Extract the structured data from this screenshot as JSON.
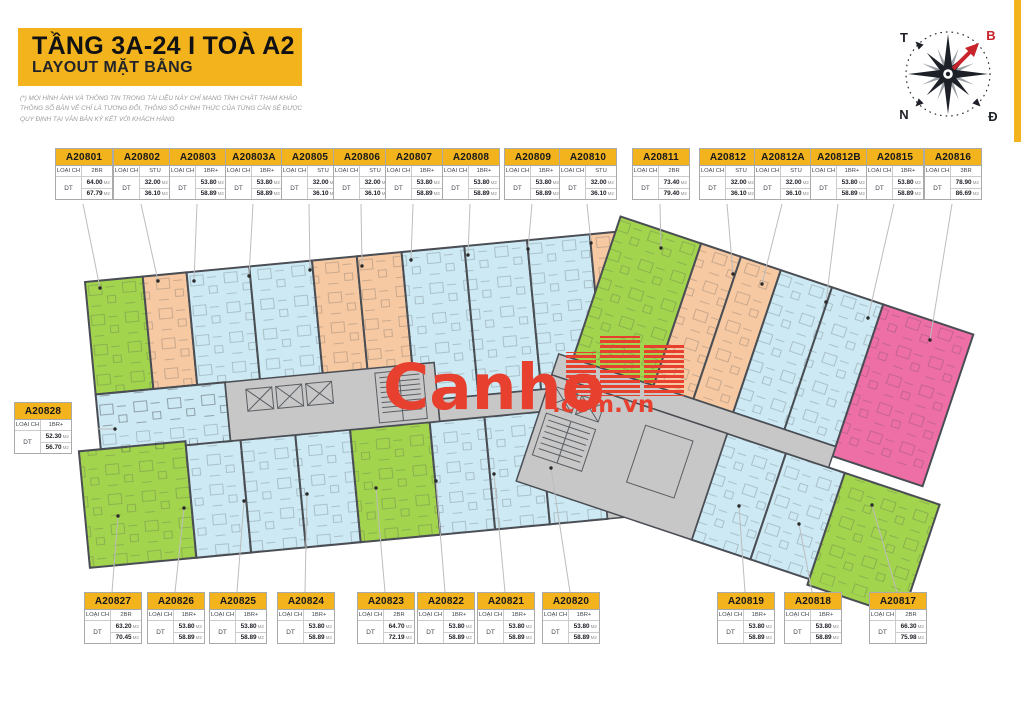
{
  "title_block": {
    "line1": "TẦNG 3A-24 I TOÀ A2",
    "line2": "LAYOUT MẶT BẰNG",
    "disclaimer": [
      "(*) MỌI HÌNH ẢNH VÀ THÔNG TIN TRONG TÀI LIỆU NÀY CHỈ MANG TÍNH CHẤT THAM KHẢO",
      "THÔNG SỐ BẢN VẼ CHỈ LÀ TƯƠNG ĐỐI, THÔNG SỐ CHÍNH THỨC CỦA TỪNG CĂN SẼ ĐƯỢC",
      "QUY ĐỊNH TẠI VĂN BẢN KÝ KẾT VỚI KHÁCH HÀNG"
    ]
  },
  "compass": {
    "nw": "T",
    "ne": "B",
    "sw": "N",
    "se": "Đ",
    "needle_color": "#c8232b"
  },
  "watermark": {
    "brand": "Canho",
    "suffix": ".com.vn",
    "color": "#e8402f"
  },
  "labels": {
    "type_key": "LOẠI CH",
    "area_key": "DT",
    "unit": "M2"
  },
  "colors": {
    "header_yellow": "#f2b31c",
    "unit_2br_green": "#a3d44e",
    "unit_stu_orange": "#f6c9a2",
    "unit_1brplus_blue": "#cde9f3",
    "unit_3br_pink": "#ee6ea6",
    "corridor_gray": "#c7c7c7",
    "brand_red": "#e8402f"
  },
  "units": {
    "top": [
      {
        "id": "A20801",
        "type": "2BR",
        "a1": "64.00",
        "a2": "67.79",
        "color": "green",
        "x": 55
      },
      {
        "id": "A20802",
        "type": "STU",
        "a1": "32.00",
        "a2": "36.10",
        "color": "orange",
        "x": 113
      },
      {
        "id": "A20803",
        "type": "1BR+",
        "a1": "53.80",
        "a2": "58.89",
        "color": "blue",
        "x": 169
      },
      {
        "id": "A20803A",
        "type": "1BR+",
        "a1": "53.80",
        "a2": "58.89",
        "color": "blue",
        "x": 225
      },
      {
        "id": "A20805",
        "type": "STU",
        "a1": "32.00",
        "a2": "36.10",
        "color": "orange",
        "x": 281
      },
      {
        "id": "A20806",
        "type": "STU",
        "a1": "32.00",
        "a2": "36.10",
        "color": "orange",
        "x": 333
      },
      {
        "id": "A20807",
        "type": "1BR+",
        "a1": "53.80",
        "a2": "58.89",
        "color": "blue",
        "x": 385
      },
      {
        "id": "A20808",
        "type": "1BR+",
        "a1": "53.80",
        "a2": "58.89",
        "color": "blue",
        "x": 442
      },
      {
        "id": "A20809",
        "type": "1BR+",
        "a1": "53.80",
        "a2": "58.89",
        "color": "blue",
        "x": 504
      },
      {
        "id": "A20810",
        "type": "STU",
        "a1": "32.00",
        "a2": "36.10",
        "color": "orange",
        "x": 559
      },
      {
        "id": "A20811",
        "type": "2BR",
        "a1": "73.40",
        "a2": "79.40",
        "color": "green",
        "x": 632
      },
      {
        "id": "A20812",
        "type": "STU",
        "a1": "32.00",
        "a2": "36.10",
        "color": "orange",
        "x": 699
      },
      {
        "id": "A20812A",
        "type": "STU",
        "a1": "32.00",
        "a2": "36.10",
        "color": "orange",
        "x": 754
      },
      {
        "id": "A20812B",
        "type": "1BR+",
        "a1": "53.80",
        "a2": "58.89",
        "color": "blue",
        "x": 810
      },
      {
        "id": "A20815",
        "type": "1BR+",
        "a1": "53.80",
        "a2": "58.89",
        "color": "blue",
        "x": 866
      },
      {
        "id": "A20816",
        "type": "3BR",
        "a1": "78.90",
        "a2": "86.69",
        "color": "pink",
        "x": 924
      }
    ],
    "left": [
      {
        "id": "A20828",
        "type": "1BR+",
        "a1": "52.30",
        "a2": "56.70",
        "color": "blue",
        "x": 14,
        "y": 402
      }
    ],
    "bottom": [
      {
        "id": "A20827",
        "type": "2BR",
        "a1": "63.20",
        "a2": "70.45",
        "color": "green",
        "x": 84
      },
      {
        "id": "A20826",
        "type": "1BR+",
        "a1": "53.80",
        "a2": "58.89",
        "color": "blue",
        "x": 147
      },
      {
        "id": "A20825",
        "type": "1BR+",
        "a1": "53.80",
        "a2": "58.89",
        "color": "blue",
        "x": 209
      },
      {
        "id": "A20824",
        "type": "1BR+",
        "a1": "53.80",
        "a2": "58.89",
        "color": "blue",
        "x": 277
      },
      {
        "id": "A20823",
        "type": "2BR",
        "a1": "64.70",
        "a2": "72.19",
        "color": "green",
        "x": 357
      },
      {
        "id": "A20822",
        "type": "1BR+",
        "a1": "53.80",
        "a2": "58.89",
        "color": "blue",
        "x": 417
      },
      {
        "id": "A20821",
        "type": "1BR+",
        "a1": "53.80",
        "a2": "58.89",
        "color": "blue",
        "x": 477
      },
      {
        "id": "A20820",
        "type": "1BR+",
        "a1": "53.80",
        "a2": "58.89",
        "color": "blue",
        "x": 542
      },
      {
        "id": "A20819",
        "type": "1BR+",
        "a1": "53.80",
        "a2": "58.89",
        "color": "blue",
        "x": 717
      },
      {
        "id": "A20818",
        "type": "1BR+",
        "a1": "53.80",
        "a2": "58.89",
        "color": "blue",
        "x": 784
      },
      {
        "id": "A20817",
        "type": "2BR",
        "a1": "66.30",
        "a2": "75.98",
        "color": "green",
        "x": 869
      }
    ]
  }
}
